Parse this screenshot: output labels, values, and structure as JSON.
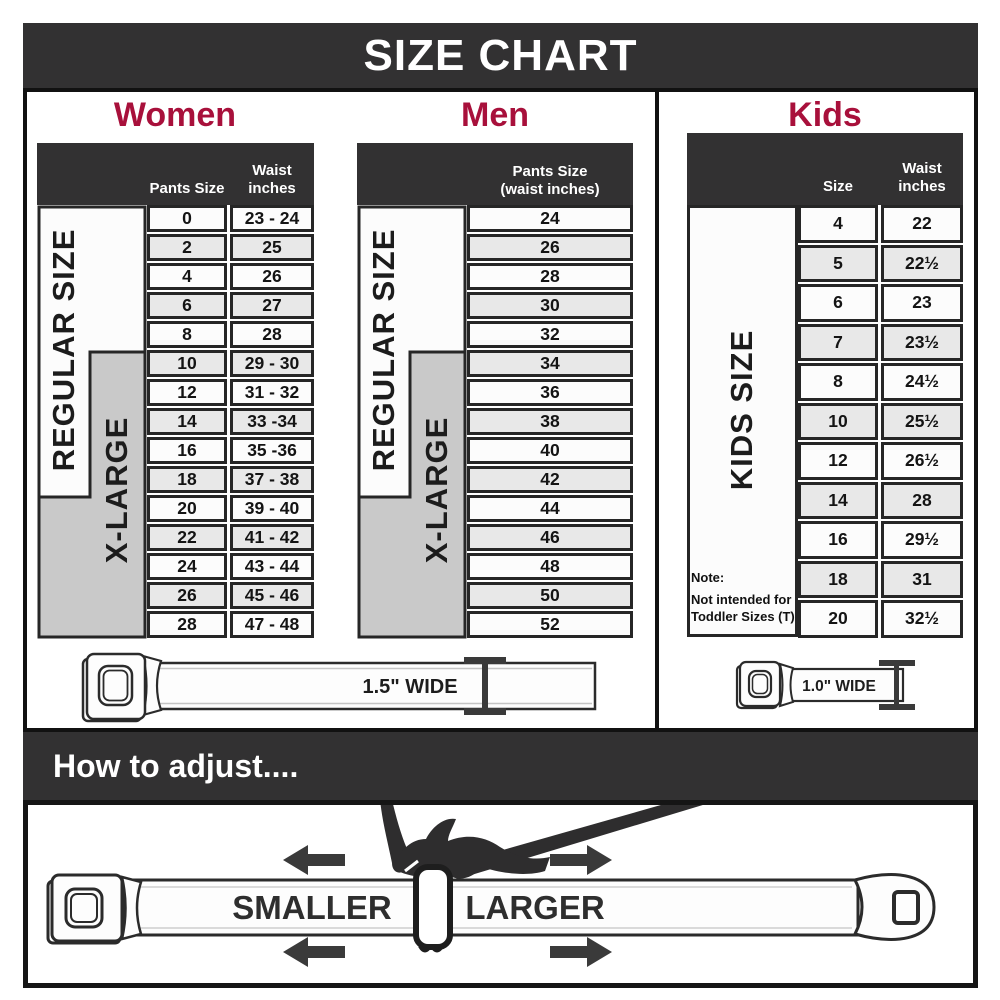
{
  "title": "SIZE CHART",
  "sections": {
    "women": {
      "heading": "Women",
      "pants_header": "Pants Size",
      "waist_header_1": "Waist",
      "waist_header_2": "inches",
      "regular_label": "REGULAR SIZE",
      "xlarge_label": "X-LARGE",
      "rows": [
        {
          "size": "0",
          "waist": "23 - 24"
        },
        {
          "size": "2",
          "waist": "25"
        },
        {
          "size": "4",
          "waist": "26"
        },
        {
          "size": "6",
          "waist": "27"
        },
        {
          "size": "8",
          "waist": "28"
        },
        {
          "size": "10",
          "waist": "29 - 30"
        },
        {
          "size": "12",
          "waist": "31 - 32"
        },
        {
          "size": "14",
          "waist": "33 -34"
        },
        {
          "size": "16",
          "waist": "35 -36"
        },
        {
          "size": "18",
          "waist": "37 - 38"
        },
        {
          "size": "20",
          "waist": "39 - 40"
        },
        {
          "size": "22",
          "waist": "41 - 42"
        },
        {
          "size": "24",
          "waist": "43 - 44"
        },
        {
          "size": "26",
          "waist": "45 - 46"
        },
        {
          "size": "28",
          "waist": "47 - 48"
        }
      ]
    },
    "men": {
      "heading": "Men",
      "col_header_1": "Pants Size",
      "col_header_2": "(waist inches)",
      "regular_label": "REGULAR SIZE",
      "xlarge_label": "X-LARGE",
      "rows": [
        "24",
        "26",
        "28",
        "30",
        "32",
        "34",
        "36",
        "38",
        "40",
        "42",
        "44",
        "46",
        "48",
        "50",
        "52"
      ]
    },
    "kids": {
      "heading": "Kids",
      "size_header": "Size",
      "waist_header_1": "Waist",
      "waist_header_2": "inches",
      "label": "KIDS SIZE",
      "note": [
        "Note:",
        "Not intended for",
        "Toddler Sizes (T)"
      ],
      "rows": [
        {
          "size": "4",
          "waist": "22"
        },
        {
          "size": "5",
          "waist": "22½"
        },
        {
          "size": "6",
          "waist": "23"
        },
        {
          "size": "7",
          "waist": "23½"
        },
        {
          "size": "8",
          "waist": "24½"
        },
        {
          "size": "10",
          "waist": "25½"
        },
        {
          "size": "12",
          "waist": "26½"
        },
        {
          "size": "14",
          "waist": "28"
        },
        {
          "size": "16",
          "waist": "29½"
        },
        {
          "size": "18",
          "waist": "31"
        },
        {
          "size": "20",
          "waist": "32½"
        }
      ]
    }
  },
  "belts": {
    "adult_width": "1.5\" WIDE",
    "kids_width": "1.0\" WIDE"
  },
  "adjust": {
    "heading": "How to adjust....",
    "smaller": "SMALLER",
    "larger": "LARGER"
  },
  "colors": {
    "bar": "#323132",
    "accent": "#A8103B",
    "xlarge_gray": "#c9c9c9",
    "row_alt": "#e8e8e8"
  }
}
